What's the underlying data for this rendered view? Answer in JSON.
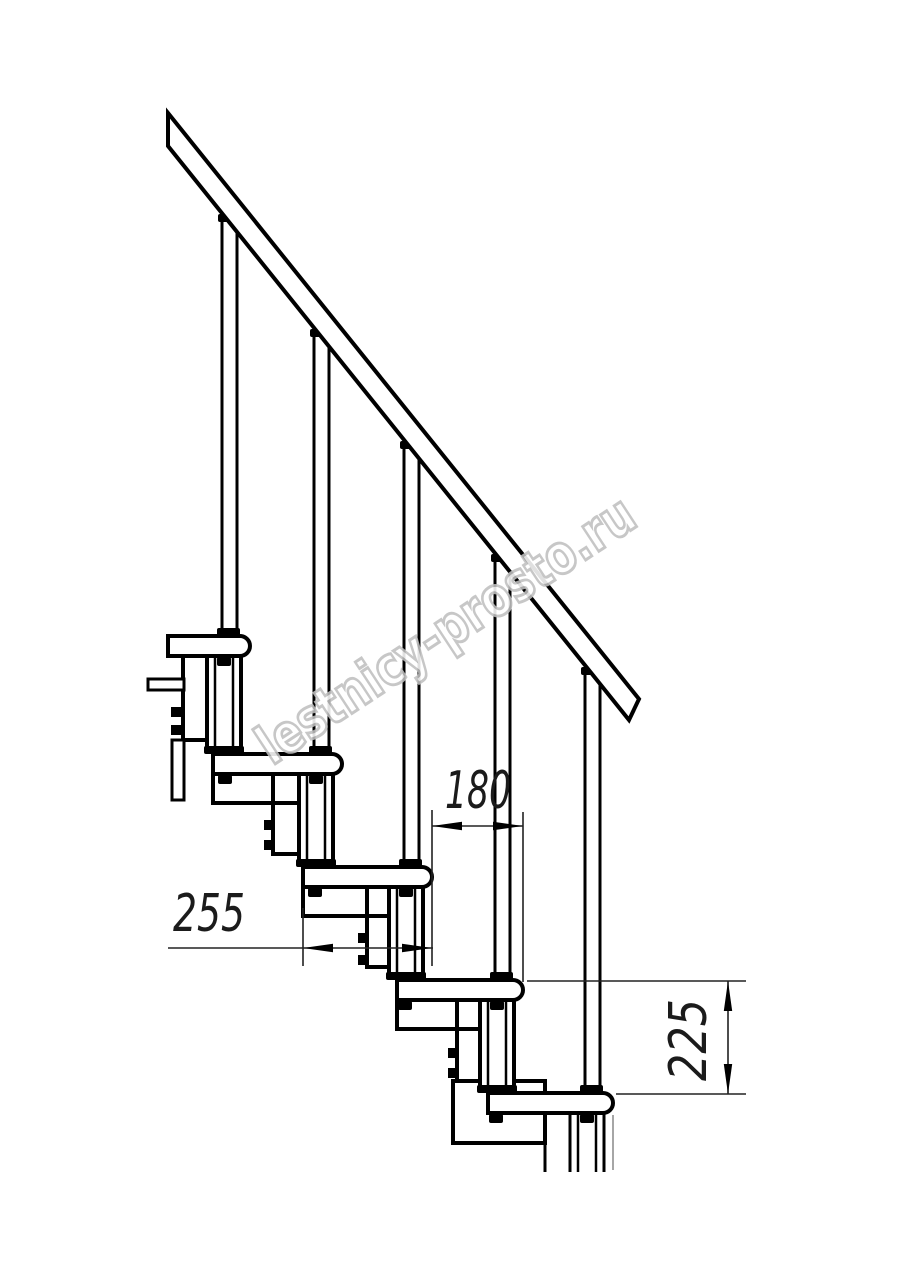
{
  "drawing": {
    "kind": "modular-staircase-side-elevation",
    "background": "#ffffff",
    "line_color": "#000000",
    "thin_line_color": "#222222",
    "dimension_text_color": "#1b1b1b",
    "dimensions": {
      "tread_depth": "255",
      "step_run": "180",
      "step_rise": "225"
    },
    "watermark": {
      "text": "lestnicy-prosto.ru",
      "outline_color": "#c0c0c0",
      "fill_color": "#ffffff"
    },
    "counts": {
      "treads": 5,
      "balusters": 5,
      "support_columns": 5
    }
  }
}
